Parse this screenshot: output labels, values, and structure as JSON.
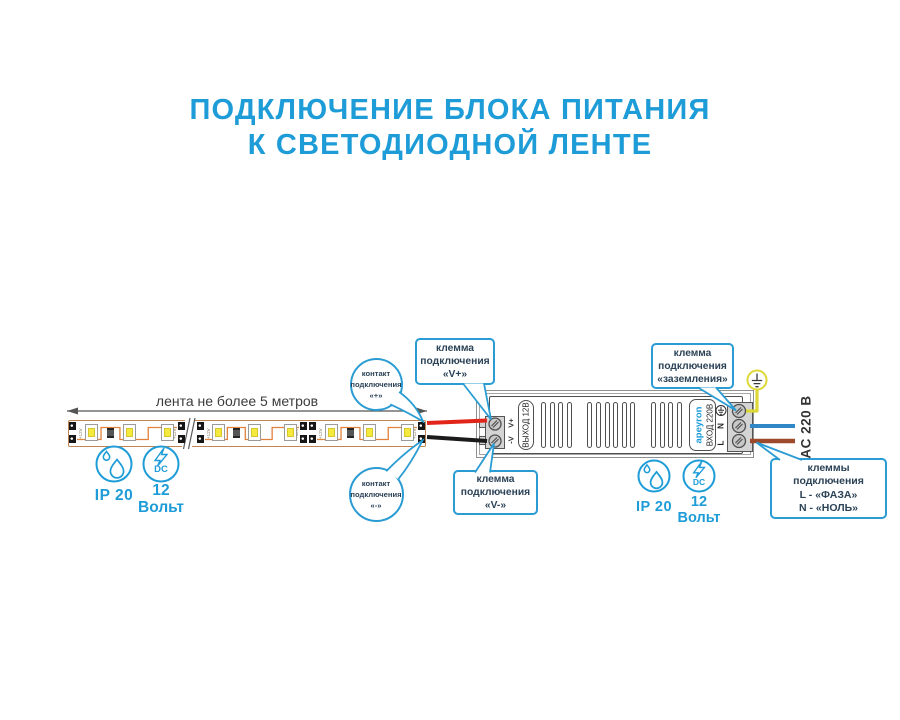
{
  "title": {
    "line1": "ПОДКЛЮЧЕНИЕ БЛОКА ПИТАНИЯ",
    "line2": "К СВЕТОДИОДНОЙ ЛЕНТЕ"
  },
  "strip": {
    "dimension_label": "лента не более 5 метров",
    "pad_label": "+12V"
  },
  "callouts": {
    "contact_plus": {
      "l1": "контакт",
      "l2": "подключения",
      "l3": "«+»"
    },
    "contact_minus": {
      "l1": "контакт",
      "l2": "подключения",
      "l3": "«-»"
    },
    "terminal_vplus": {
      "l1": "клемма",
      "l2": "подключения",
      "l3": "«V+»"
    },
    "terminal_vminus": {
      "l1": "клемма",
      "l2": "подключения",
      "l3": "«V-»"
    },
    "terminal_ground": {
      "l1": "клемма",
      "l2": "подключения",
      "l3": "«заземления»"
    },
    "terminal_mains": {
      "l1": "клеммы",
      "l2": "подключения",
      "l3": "L - «ФАЗА»",
      "l4": "N - «НОЛЬ»"
    }
  },
  "psu": {
    "output_terminal_plus": "V+",
    "output_terminal_minus": "-V",
    "output_label": "ВЫХОД 12В",
    "brand": "apeyron",
    "input_label": "ВХОД 220В",
    "input_line": "L",
    "input_neutral": "N",
    "ac_label": "AC 220 В"
  },
  "badges_left": {
    "ip": "IP 20",
    "dc": "DC",
    "volt1": "12",
    "volt2": "Вольт"
  },
  "badges_right": {
    "ip": "IP 20",
    "dc": "DC",
    "volt1": "12",
    "volt2": "Вольт"
  },
  "colors": {
    "accent": "#1e9cd7",
    "callout-border": "#2a9cd3",
    "callout-text": "#2b4257",
    "wire-red": "#e1251b",
    "wire-black": "#1b1b1b",
    "wire-yellow": "#ddd837",
    "wire-blue": "#2f87c6",
    "wire-brown": "#9c4a2b",
    "strip-border": "#c08552",
    "trace": "#e0813c",
    "led-core": "#f4ea3d",
    "outline": "#4f4f4f",
    "dim": "#3c3c3c"
  }
}
